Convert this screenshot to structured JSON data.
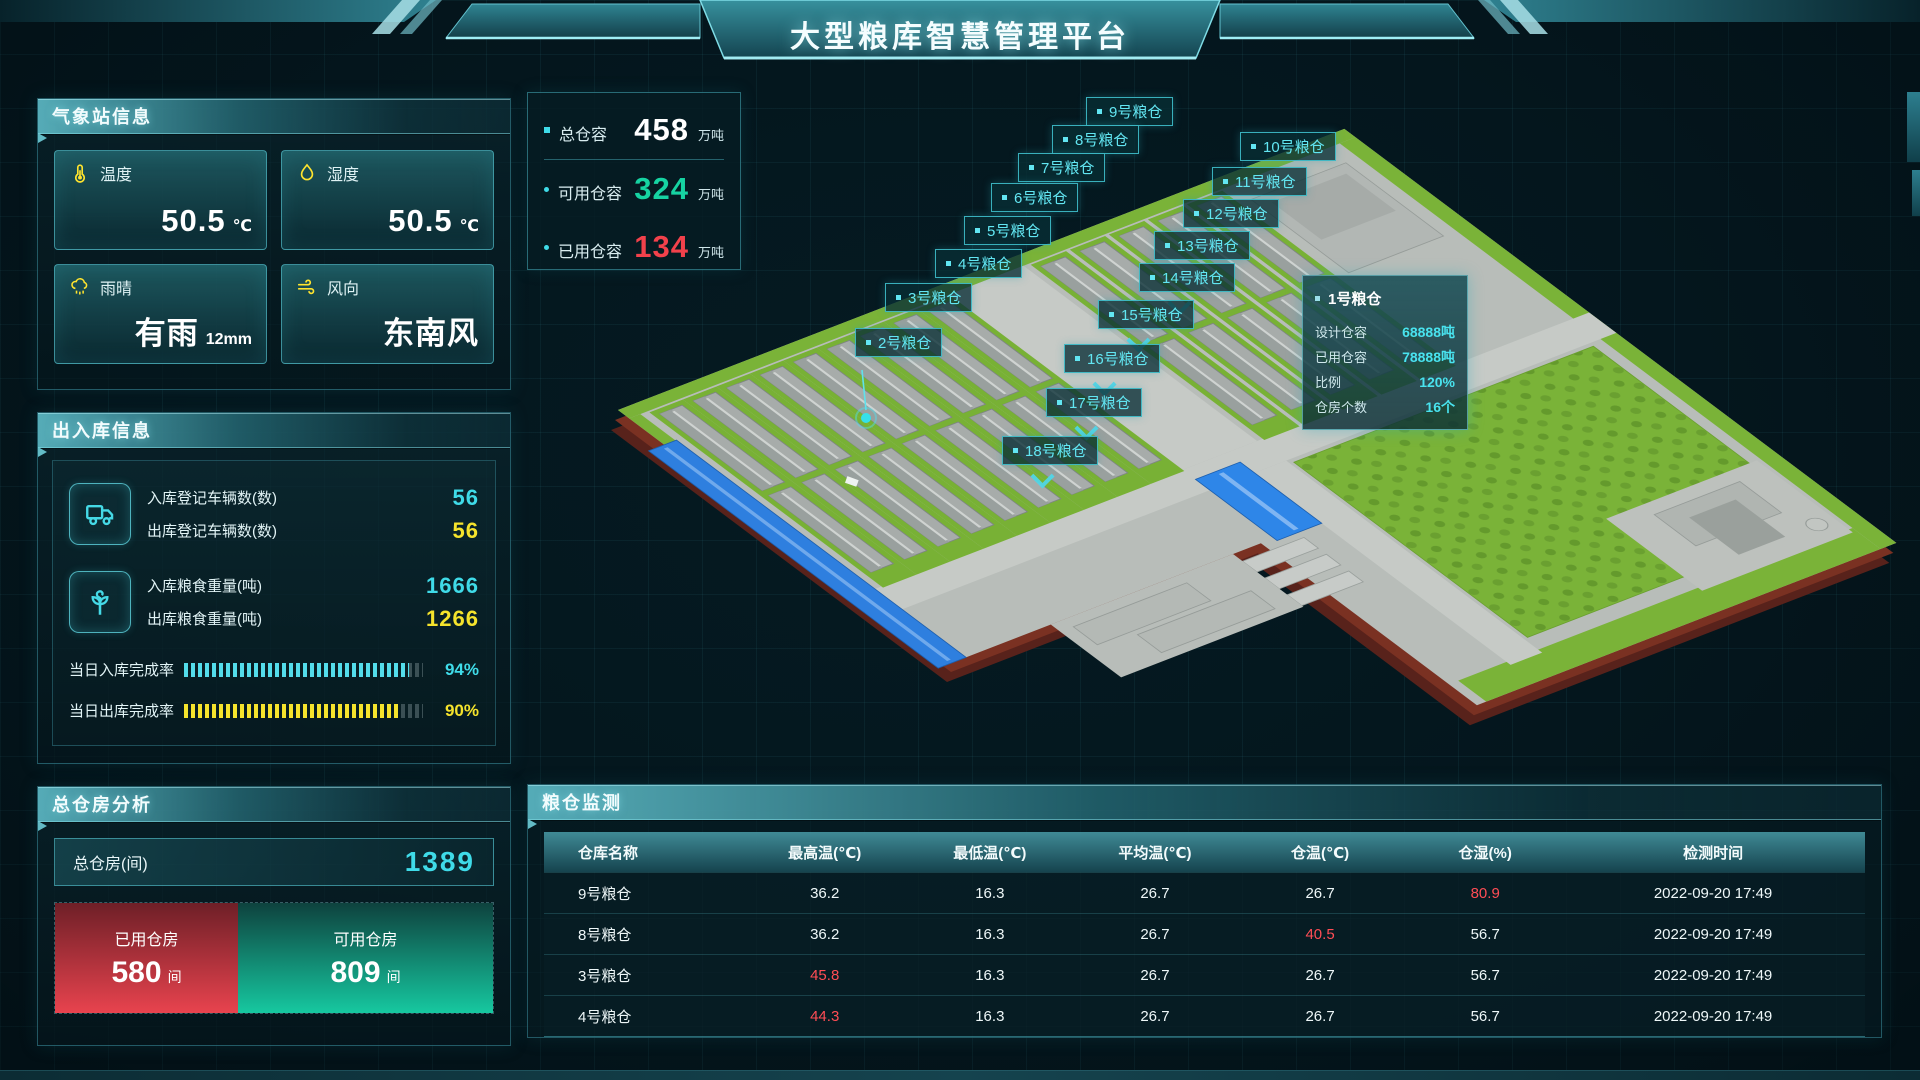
{
  "header": {
    "title": "大型粮库智慧管理平台"
  },
  "weather": {
    "title": "气象站信息",
    "cards": [
      {
        "icon": "thermometer-icon",
        "label": "温度",
        "value": "50.5",
        "unit": "℃"
      },
      {
        "icon": "humidity-icon",
        "label": "湿度",
        "value": "50.5",
        "unit": "℃"
      },
      {
        "icon": "rain-icon",
        "label": "雨晴",
        "value": "有雨",
        "unit": "12mm"
      },
      {
        "icon": "wind-icon",
        "label": "风向",
        "value": "东南风",
        "unit": ""
      }
    ]
  },
  "inout": {
    "title": "出入库信息",
    "groups": [
      {
        "icon": "truck-icon",
        "rows": [
          {
            "label": "入库登记车辆数(数)",
            "value": "56",
            "color": "cyan"
          },
          {
            "label": "出库登记车辆数(数)",
            "value": "56",
            "color": "yellow"
          }
        ]
      },
      {
        "icon": "sprout-icon",
        "rows": [
          {
            "label": "入库粮食重量(吨)",
            "value": "1666",
            "color": "cyan"
          },
          {
            "label": "出库粮食重量(吨)",
            "value": "1266",
            "color": "yellow"
          }
        ]
      }
    ],
    "progress": [
      {
        "label": "当日入库完成率",
        "percent": 94,
        "color": "cyan"
      },
      {
        "label": "当日出库完成率",
        "percent": 90,
        "color": "yellow"
      }
    ]
  },
  "capacity": {
    "items": [
      {
        "label": "总仓容",
        "value": "458",
        "unit": "万吨",
        "color": "white",
        "bullet": "square"
      },
      {
        "label": "可用仓容",
        "value": "324",
        "unit": "万吨",
        "color": "green",
        "bullet": "dot"
      },
      {
        "label": "已用仓容",
        "value": "134",
        "unit": "万吨",
        "color": "red",
        "bullet": "dot"
      }
    ]
  },
  "analysis": {
    "title": "总仓房分析",
    "total_label": "总仓房(间)",
    "total_value": "1389",
    "used": {
      "label": "已用仓房",
      "value": "580",
      "unit": "间"
    },
    "available": {
      "label": "可用仓房",
      "value": "809",
      "unit": "间"
    }
  },
  "map": {
    "labels": [
      {
        "name": "9号粮仓",
        "x": 1086,
        "y": 97
      },
      {
        "name": "8号粮仓",
        "x": 1052,
        "y": 125
      },
      {
        "name": "10号粮仓",
        "x": 1240,
        "y": 132
      },
      {
        "name": "7号粮仓",
        "x": 1018,
        "y": 153
      },
      {
        "name": "11号粮仓",
        "x": 1212,
        "y": 167
      },
      {
        "name": "6号粮仓",
        "x": 991,
        "y": 183
      },
      {
        "name": "12号粮仓",
        "x": 1183,
        "y": 199
      },
      {
        "name": "5号粮仓",
        "x": 964,
        "y": 216
      },
      {
        "name": "13号粮仓",
        "x": 1154,
        "y": 231
      },
      {
        "name": "4号粮仓",
        "x": 935,
        "y": 249
      },
      {
        "name": "14号粮仓",
        "x": 1139,
        "y": 263,
        "marker": true
      },
      {
        "name": "3号粮仓",
        "x": 885,
        "y": 283
      },
      {
        "name": "15号粮仓",
        "x": 1098,
        "y": 300,
        "marker": true
      },
      {
        "name": "2号粮仓",
        "x": 855,
        "y": 328
      },
      {
        "name": "16号粮仓",
        "x": 1064,
        "y": 344,
        "marker": true
      },
      {
        "name": "17号粮仓",
        "x": 1046,
        "y": 388,
        "marker": true
      },
      {
        "name": "18号粮仓",
        "x": 1002,
        "y": 436,
        "marker": true
      }
    ],
    "tooltip": {
      "title": "1号粮仓",
      "rows": [
        {
          "label": "设计仓容",
          "value": "68888吨"
        },
        {
          "label": "已用仓容",
          "value": "78888吨"
        },
        {
          "label": "比例",
          "value": "120%"
        },
        {
          "label": "仓房个数",
          "value": "16个"
        }
      ]
    }
  },
  "monitor": {
    "title": "粮仓监测",
    "columns": [
      "仓库名称",
      "最高温(℃)",
      "最低温(℃)",
      "平均温(℃)",
      "仓温(℃)",
      "仓湿(%)",
      "检测时间"
    ],
    "rows": [
      {
        "cells": [
          "9号粮仓",
          "36.2",
          "16.3",
          "26.7",
          "26.7",
          "80.9",
          "2022-09-20 17:49"
        ],
        "red": [
          5
        ]
      },
      {
        "cells": [
          "8号粮仓",
          "36.2",
          "16.3",
          "26.7",
          "40.5",
          "56.7",
          "2022-09-20 17:49"
        ],
        "red": [
          4
        ]
      },
      {
        "cells": [
          "3号粮仓",
          "45.8",
          "16.3",
          "26.7",
          "26.7",
          "56.7",
          "2022-09-20 17:49"
        ],
        "red": [
          1
        ]
      },
      {
        "cells": [
          "4号粮仓",
          "44.3",
          "16.3",
          "26.7",
          "26.7",
          "56.7",
          "2022-09-20 17:49"
        ],
        "red": [
          1
        ]
      }
    ]
  }
}
